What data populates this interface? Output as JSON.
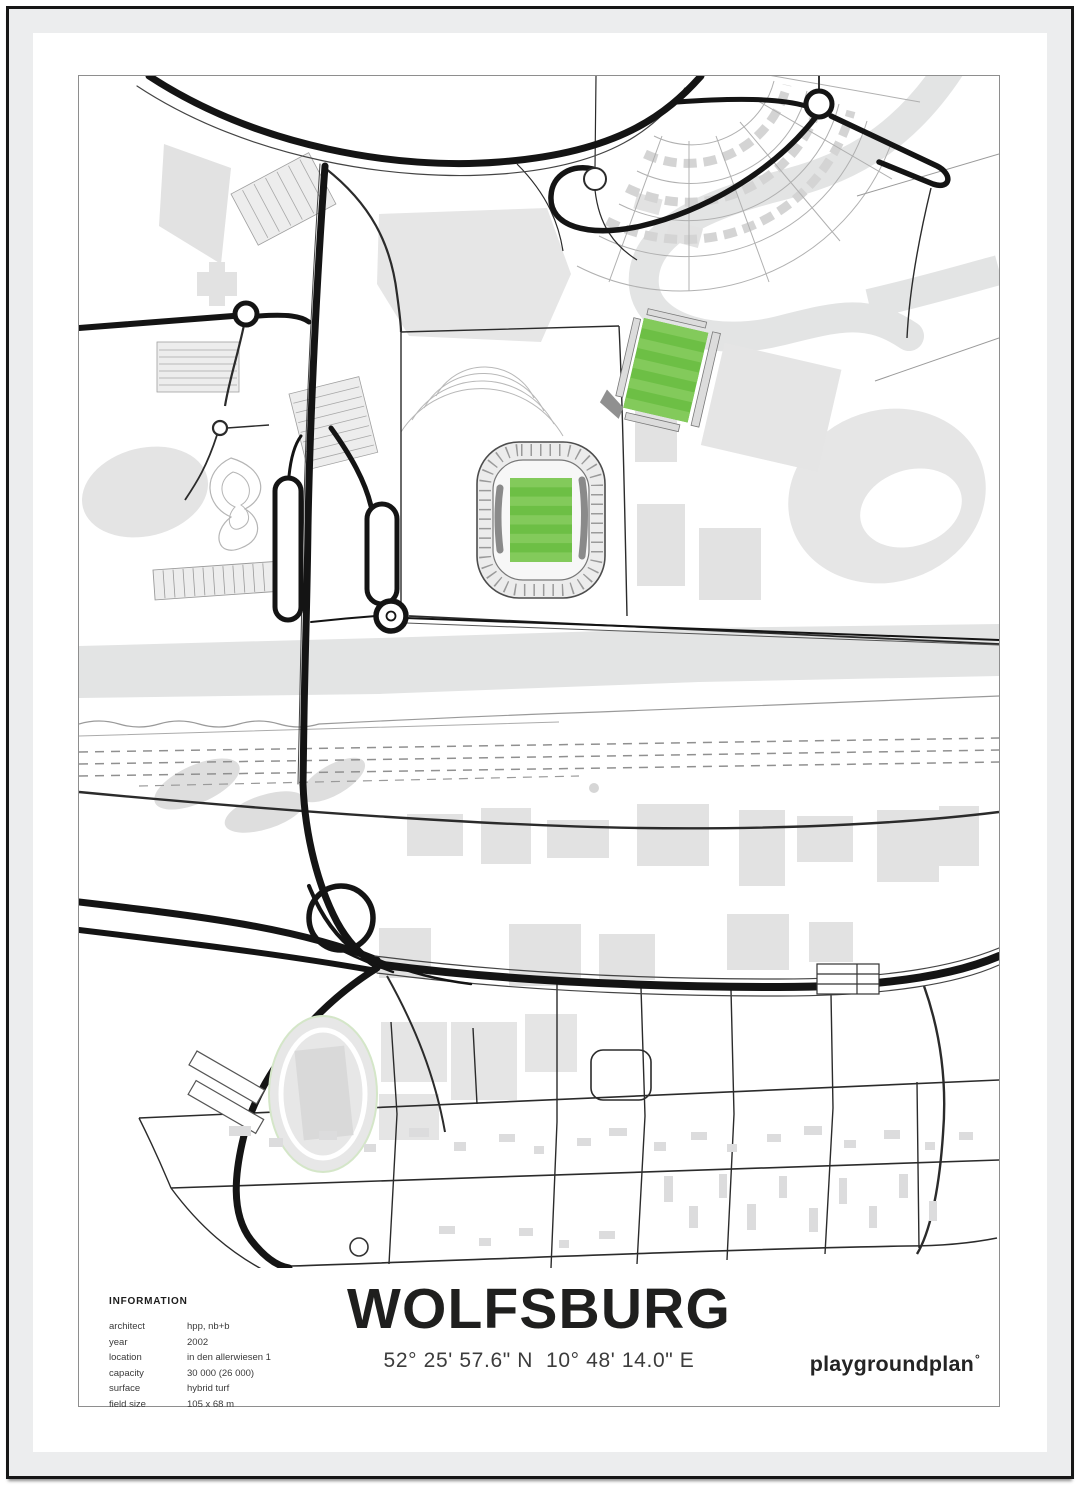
{
  "poster": {
    "title": "WOLFSBURG",
    "coordinates": "52° 25' 57.6\" N  10° 48' 14.0\" E",
    "brand": "playgroundplan",
    "brand_degree": "°",
    "info": {
      "heading": "INFORMATION",
      "rows": [
        {
          "label": "architect",
          "value": "hpp, nb+b"
        },
        {
          "label": "year",
          "value": "2002"
        },
        {
          "label": "location",
          "value": "in den allerwiesen 1"
        },
        {
          "label": "capacity",
          "value": "30 000 (26 000)"
        },
        {
          "label": "surface",
          "value": "hybrid turf"
        },
        {
          "label": "field size",
          "value": "105 x 68 m"
        }
      ]
    },
    "colors": {
      "pitch_green": "#6dbf45",
      "pitch_stripe_light": "#83ca5b",
      "water_gray": "#e3e4e4",
      "building_gray": "#e2e2e2",
      "road_black": "#141414",
      "mat_gray": "#ecedee",
      "frame_black": "#161616"
    }
  }
}
